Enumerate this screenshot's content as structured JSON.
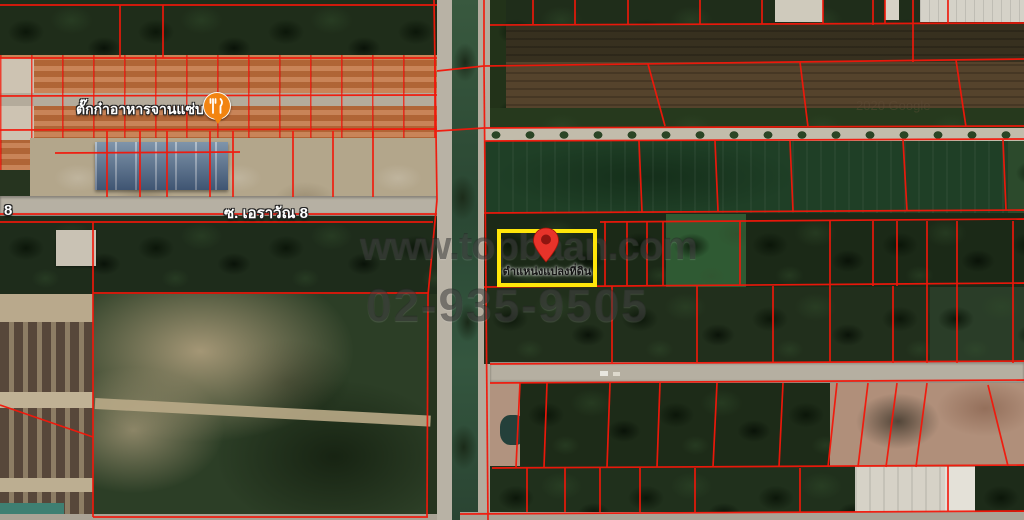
{
  "watermark": {
    "site": "www.topbaan.com",
    "phone": "02-935-9505"
  },
  "map_credit": "2020 Google",
  "highlight": {
    "plot_label": "ตำแหน่งแปลงที่ดิน"
  },
  "poi": {
    "restaurant_label": "ตั๊กก๋าอาหารจานแซ่บ"
  },
  "roads": {
    "soi_label": "ซ. เอราวัณ 8",
    "soi_label_edge": "8"
  },
  "colors": {
    "parcel_line": "#f3170a",
    "highlight_box": "#ffe60a",
    "pin": "#e8332a",
    "pin_inner": "#8f1510",
    "poi_bg": "#f28411"
  }
}
